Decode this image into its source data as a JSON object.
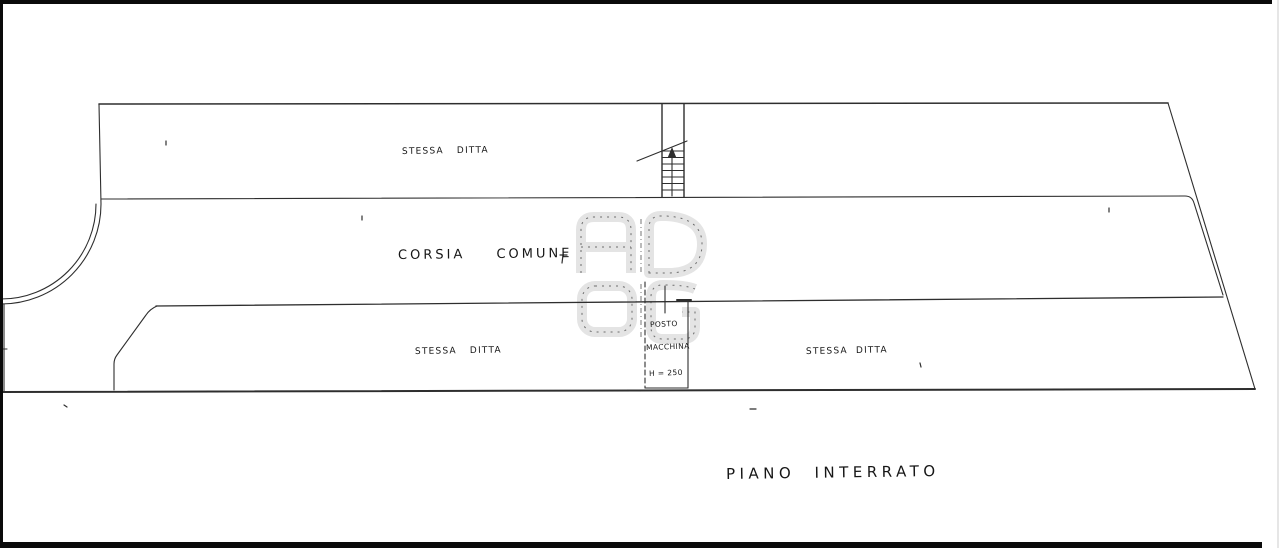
{
  "floor_plan": {
    "title": "PIANO INTERRATO",
    "areas": {
      "upper_unit_label": "STESSA DITTA",
      "corridor_label": "CORSIA COMUNE",
      "lower_left_unit_label": "STESSA DITTA",
      "lower_right_unit_label": "STESSA DITTA"
    },
    "parking_space": {
      "line1": "POSTO",
      "line2": "MACCHINA",
      "height_note": "H = 250"
    },
    "watermark_letters": [
      "A",
      "D",
      "O",
      "G"
    ],
    "colors": {
      "ink": "#2e2e2e",
      "watermark": "#e4e4e4",
      "paper": "#ffffff",
      "sheet_border": "#0a0a0a"
    }
  }
}
